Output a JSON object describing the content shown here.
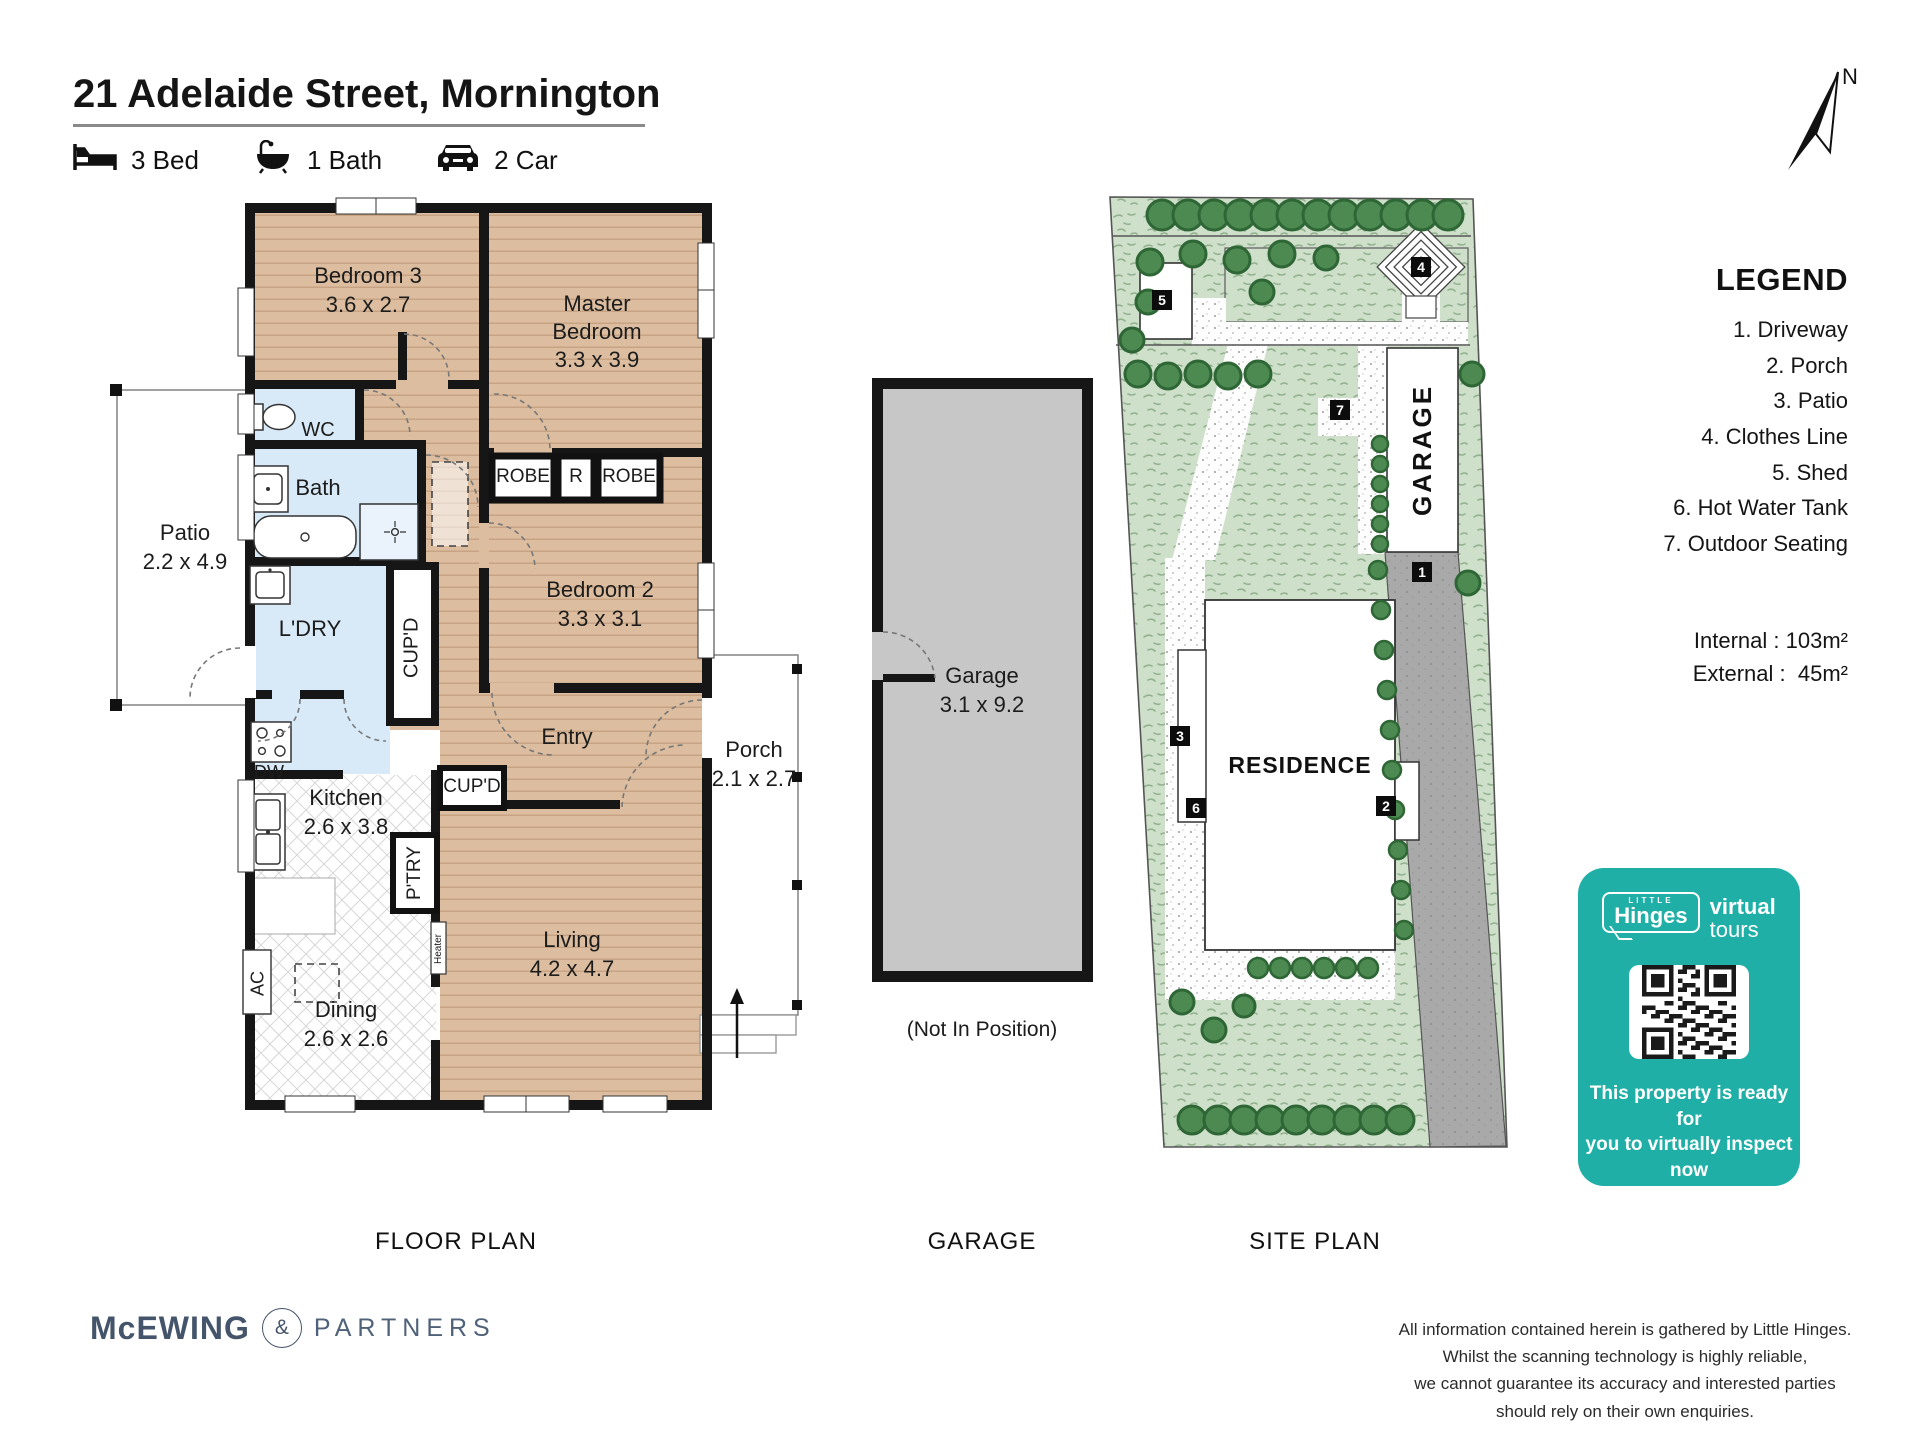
{
  "header": {
    "address": "21 Adelaide Street, Mornington",
    "beds": "3 Bed",
    "baths": "1 Bath",
    "cars": "2 Car"
  },
  "floor_plan": {
    "caption": "FLOOR PLAN",
    "rooms": {
      "bedroom3": {
        "name": "Bedroom 3",
        "dims": "3.6 x 2.7"
      },
      "master": {
        "name": "Master Bedroom",
        "dims": "3.3 x 3.9"
      },
      "bedroom2": {
        "name": "Bedroom 2",
        "dims": "3.3 x 3.1"
      },
      "living": {
        "name": "Living",
        "dims": "4.2 x 4.7"
      },
      "kitchen": {
        "name": "Kitchen",
        "dims": "2.6 x 3.8"
      },
      "dining": {
        "name": "Dining",
        "dims": "2.6 x 2.6"
      },
      "patio": {
        "name": "Patio",
        "dims": "2.2 x 4.9"
      },
      "porch": {
        "name": "Porch",
        "dims": "2.1 x 2.7"
      },
      "entry": {
        "name": "Entry"
      },
      "wc": {
        "name": "WC"
      },
      "bath": {
        "name": "Bath"
      },
      "laundry": {
        "name": "L'DRY"
      },
      "cupboard_hall": {
        "name": "CUP'D"
      },
      "cupboard_entry": {
        "name": "CUP'D"
      },
      "pantry": {
        "name": "P'TRY"
      },
      "robe_left": {
        "name": "ROBE"
      },
      "robe_small": {
        "name": "R"
      },
      "robe_right": {
        "name": "ROBE"
      },
      "dishwasher": {
        "name": "DW"
      },
      "ac": {
        "name": "AC"
      },
      "heater": {
        "name": "Heater"
      }
    }
  },
  "garage_plan": {
    "caption": "GARAGE",
    "room": {
      "name": "Garage",
      "dims": "3.1 x 9.2"
    },
    "note": "(Not In Position)"
  },
  "site_plan": {
    "caption": "SITE PLAN",
    "garage_label": "GARAGE",
    "residence_label": "RESIDENCE",
    "north": "N",
    "markers": [
      "1",
      "2",
      "3",
      "4",
      "5",
      "6",
      "7"
    ]
  },
  "legend": {
    "title": "LEGEND",
    "items": [
      "1. Driveway",
      "2. Porch",
      "3. Patio",
      "4. Clothes Line",
      "5. Shed",
      "6. Hot Water Tank",
      "7. Outdoor Seating"
    ],
    "internal_label": "Internal :",
    "internal_value": "103m²",
    "external_label": "External :",
    "external_value": "45m²"
  },
  "promo_card": {
    "color": "#1fafa6",
    "logo_little": "LITTLE",
    "logo_hinges": "Hinges",
    "logo_virtual": "virtual",
    "logo_tours": "tours",
    "line1": "This property is ready for",
    "line2": "you to virtually inspect now",
    "url": "littlehinges.com.au"
  },
  "branding": {
    "agency_name": "McEWING",
    "agency_amp": "&",
    "agency_partners": "PARTNERS"
  },
  "disclaimer": {
    "lines": [
      "All information contained herein is gathered by Little Hinges.",
      "Whilst the scanning technology is highly reliable,",
      "we cannot guarantee its accuracy and interested parties",
      "should rely on their own enquiries."
    ]
  }
}
